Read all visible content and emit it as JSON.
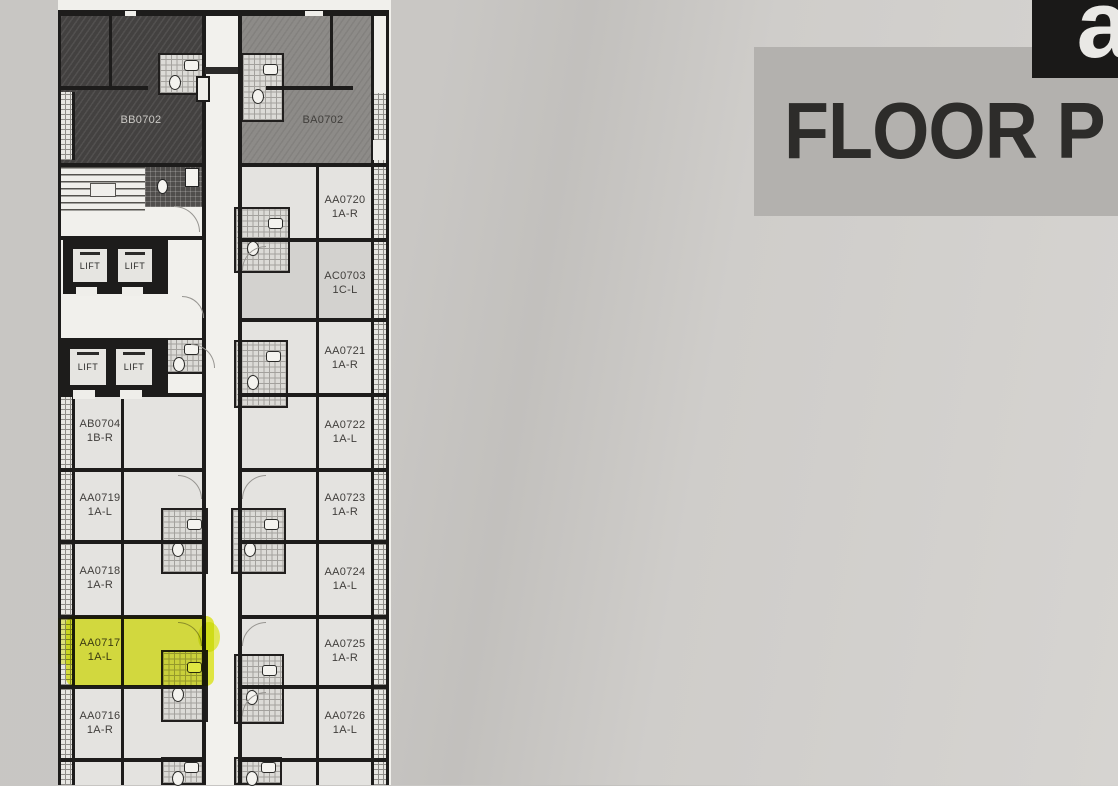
{
  "title": {
    "text": "FLOOR P",
    "band_color": "#b3b1ae",
    "text_color": "#2d2c2a"
  },
  "logo": {
    "letter": "a",
    "bg": "#1a1918",
    "fg": "#e9e8e5"
  },
  "plan": {
    "lift_label": "LIFT",
    "highlight_color": "#e7f126",
    "colors": {
      "dark_unit": "#434140",
      "medium_unit": "#8d8b88",
      "light_unit": "#e4e3e0",
      "darker_unit": "#d3d2cf",
      "walls": "#1d1c1b",
      "paper": "#f1f0ec"
    },
    "units": [
      {
        "id": "BB0702",
        "type": ""
      },
      {
        "id": "BA0702",
        "type": ""
      },
      {
        "id": "AA0720",
        "type": "1A-R"
      },
      {
        "id": "AC0703",
        "type": "1C-L"
      },
      {
        "id": "AA0721",
        "type": "1A-R"
      },
      {
        "id": "AA0722",
        "type": "1A-L"
      },
      {
        "id": "AA0723",
        "type": "1A-R"
      },
      {
        "id": "AA0724",
        "type": "1A-L"
      },
      {
        "id": "AA0725",
        "type": "1A-R"
      },
      {
        "id": "AA0726",
        "type": "1A-L"
      },
      {
        "id": "AB0704",
        "type": "1B-R"
      },
      {
        "id": "AA0719",
        "type": "1A-L"
      },
      {
        "id": "AA0718",
        "type": "1A-R"
      },
      {
        "id": "AA0717",
        "type": "1A-L",
        "highlighted": true
      },
      {
        "id": "AA0716",
        "type": "1A-R"
      }
    ]
  }
}
